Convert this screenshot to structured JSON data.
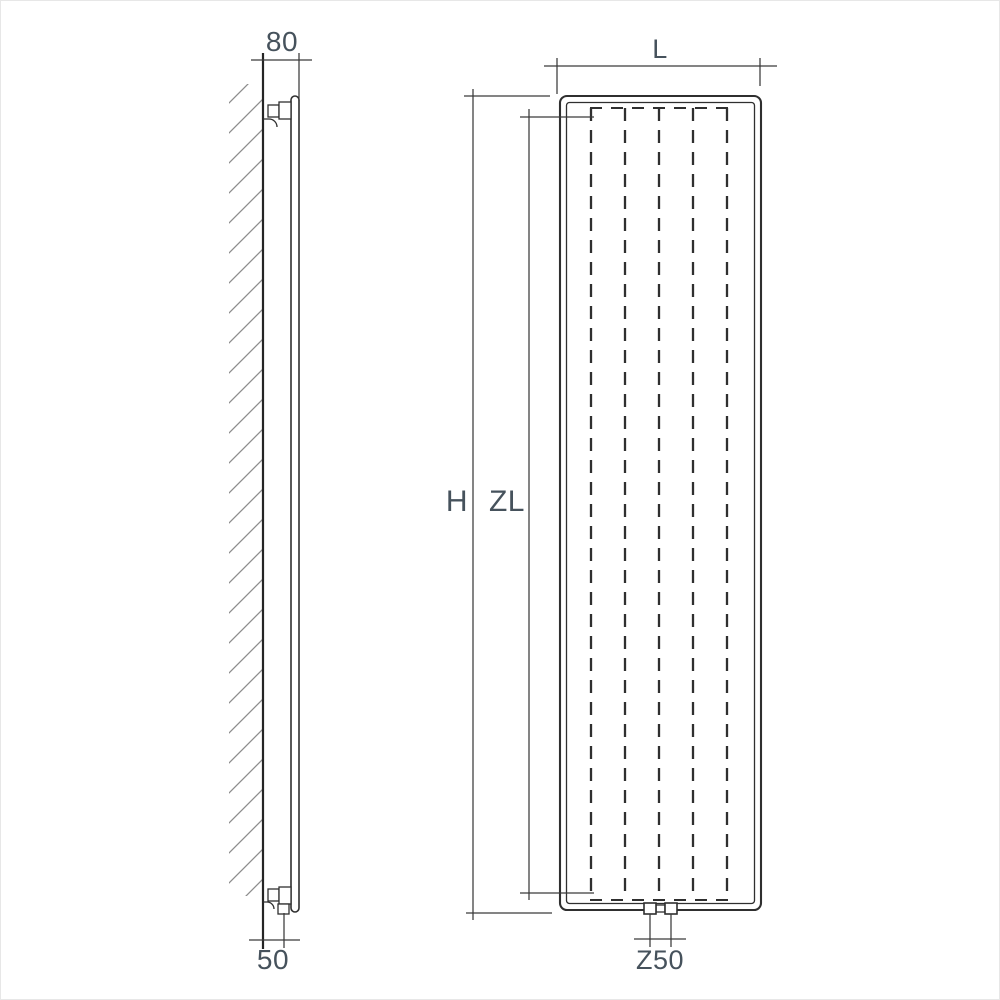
{
  "diagram": {
    "labels": {
      "side_top_offset": "80",
      "side_bottom_offset": "50",
      "front_width": "L",
      "front_height": "H",
      "front_inner_height": "ZL",
      "front_connection_spacing": "Z50"
    },
    "colors": {
      "line": "#2f2f2f",
      "dimension_line": "#3a3a3a",
      "hatch": "#8d8d8d",
      "label_text": "#46525c",
      "background": "#ffffff"
    }
  }
}
